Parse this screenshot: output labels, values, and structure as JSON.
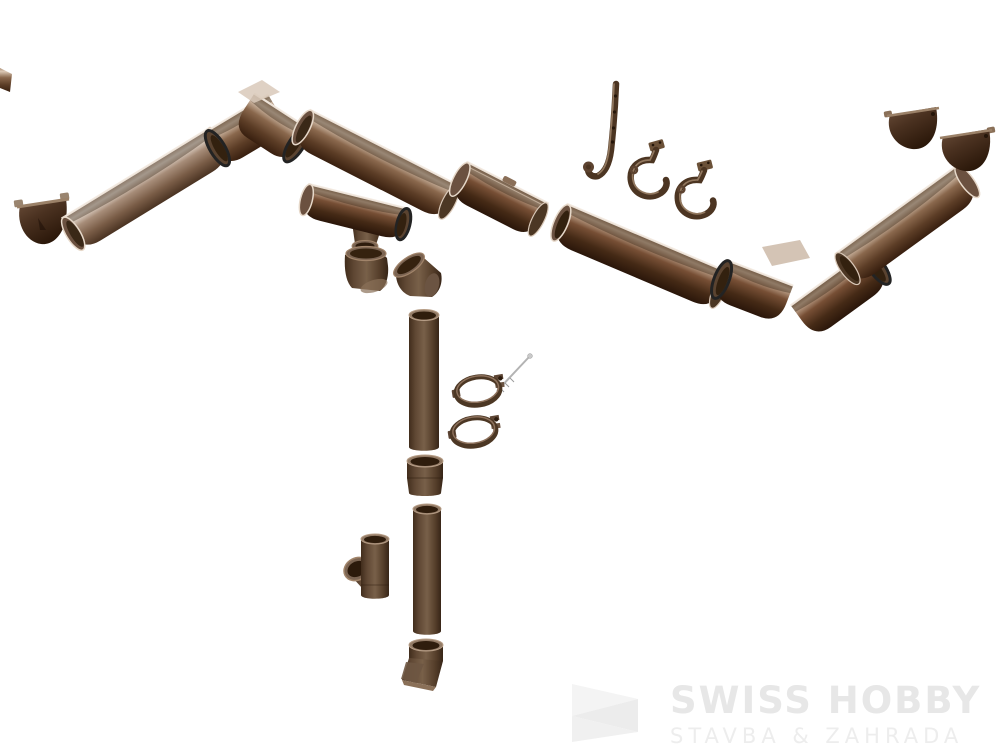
{
  "image": {
    "type": "product-render",
    "background": "#ffffff",
    "description": "Exploded assembly view of a brown half-round rain gutter and round downpipe system on a white background"
  },
  "palette": {
    "gutter_light": "#a98e7b",
    "gutter_mid": "#7d5f49",
    "gutter_dark": "#4f3522",
    "pipe_brown": "#5d4534",
    "end_cap_dark": "#3a2515",
    "rim_highlight": "#f2e9df",
    "gasket_black": "#232323",
    "screw_metal": "#b3b3b3"
  },
  "watermark": {
    "title": "SWISS HOBBY",
    "subtitle": "STAVBA & ZAHRADA",
    "title_color": "#e7e7e7",
    "subtitle_color": "#ededed",
    "mark": "folded-ribbon-s"
  },
  "parts": [
    {
      "id": "gutter-fragment-left-edge",
      "label": "gutter fragment at image edge"
    },
    {
      "id": "gutter-end-cap-left",
      "label": "gutter end cap"
    },
    {
      "id": "gutter-section-left",
      "label": "half-round gutter section"
    },
    {
      "id": "gutter-corner-left",
      "label": "90-degree gutter corner"
    },
    {
      "id": "gutter-section-mid",
      "label": "half-round gutter section"
    },
    {
      "id": "gutter-connector",
      "label": "gutter joint connector"
    },
    {
      "id": "gutter-drop-outlet",
      "label": "gutter drop outlet with funnel"
    },
    {
      "id": "pipe-elbow-left",
      "label": "downpipe elbow"
    },
    {
      "id": "pipe-elbow-right",
      "label": "downpipe elbow"
    },
    {
      "id": "rafter-strap-hook",
      "label": "long strap gutter hook"
    },
    {
      "id": "gutter-hook-1",
      "label": "fascia gutter hook"
    },
    {
      "id": "gutter-hook-2",
      "label": "fascia gutter hook"
    },
    {
      "id": "gutter-section-dark",
      "label": "half-round gutter section"
    },
    {
      "id": "gutter-corner-right",
      "label": "90-degree gutter corner"
    },
    {
      "id": "gutter-section-right",
      "label": "half-round gutter section"
    },
    {
      "id": "gutter-end-cap-right-1",
      "label": "gutter end cap"
    },
    {
      "id": "gutter-end-cap-right-2",
      "label": "gutter end cap"
    },
    {
      "id": "downpipe-upper",
      "label": "downpipe tube"
    },
    {
      "id": "mounting-screw",
      "label": "clamp mounting screw"
    },
    {
      "id": "pipe-clamp-upper",
      "label": "downpipe clamp ring"
    },
    {
      "id": "pipe-clamp-lower",
      "label": "downpipe clamp ring"
    },
    {
      "id": "pipe-coupler",
      "label": "pipe coupler sleeve"
    },
    {
      "id": "downpipe-lower",
      "label": "downpipe tube"
    },
    {
      "id": "pipe-tee",
      "label": "downpipe tee branch"
    },
    {
      "id": "downpipe-outlet-shoe",
      "label": "downpipe outlet shoe"
    }
  ]
}
